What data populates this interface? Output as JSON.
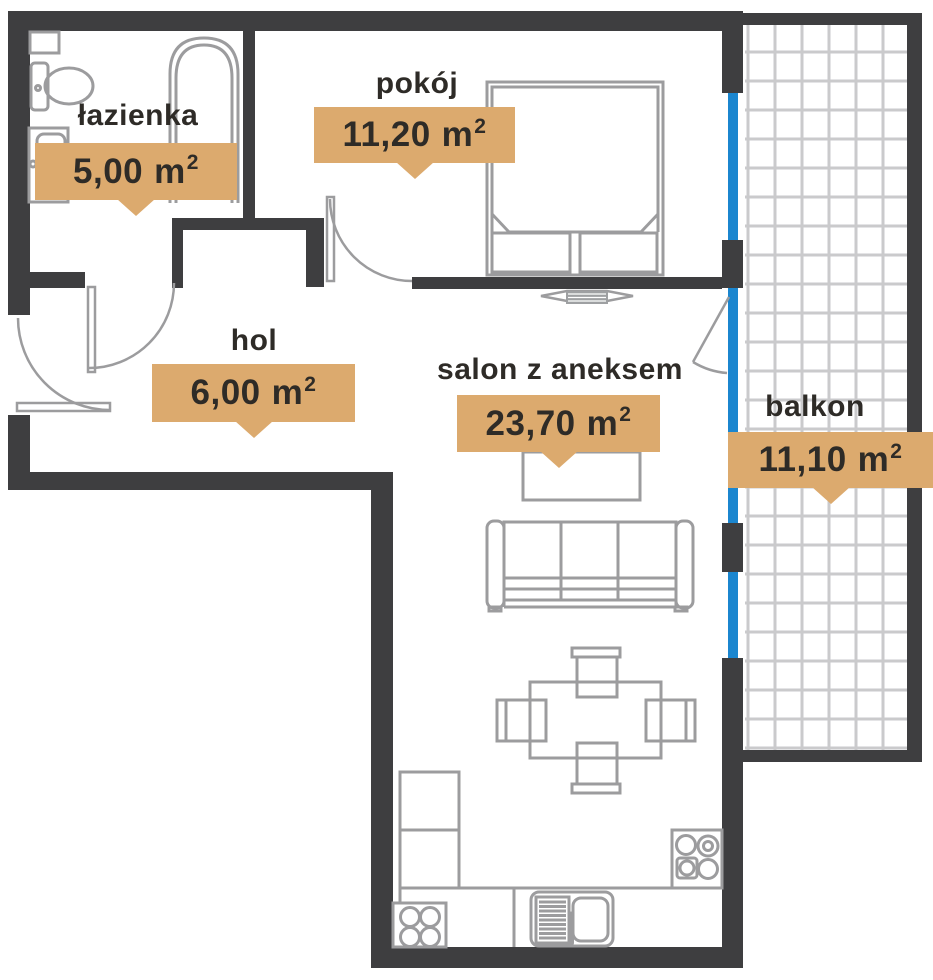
{
  "rooms": [
    {
      "name": "łazienka",
      "area": "5,00",
      "unit": "m",
      "sup": "2"
    },
    {
      "name": "pokój",
      "area": "11,20",
      "unit": "m",
      "sup": "2"
    },
    {
      "name": "hol",
      "area": "6,00",
      "unit": "m",
      "sup": "2"
    },
    {
      "name": "salon z aneksem",
      "area": "23,70",
      "unit": "m",
      "sup": "2"
    },
    {
      "name": "balkon",
      "area": "11,10",
      "unit": "m",
      "sup": "2"
    }
  ],
  "colors": {
    "wall": "#3e3e40",
    "window_glass": "#1b86cf",
    "area_badge": "#dcaa6e",
    "furniture_line": "#9c9c9e",
    "balcony_tile_line": "#cacacc",
    "text": "#2e2b27"
  },
  "icons": [
    "toilet-icon",
    "bathroom-sink-icon",
    "bathtub-icon",
    "bathroom-shelf-icon",
    "double-bed-icon",
    "tv-icon",
    "coffee-table-icon",
    "sofa-icon",
    "dining-table-icon",
    "chair-icon",
    "kitchen-cabinets-icon",
    "hob-icon",
    "kitchen-sink-icon",
    "cooktop-icon",
    "entrance-door-icon",
    "bathroom-door-icon",
    "bedroom-door-icon",
    "balcony-door-icon"
  ]
}
